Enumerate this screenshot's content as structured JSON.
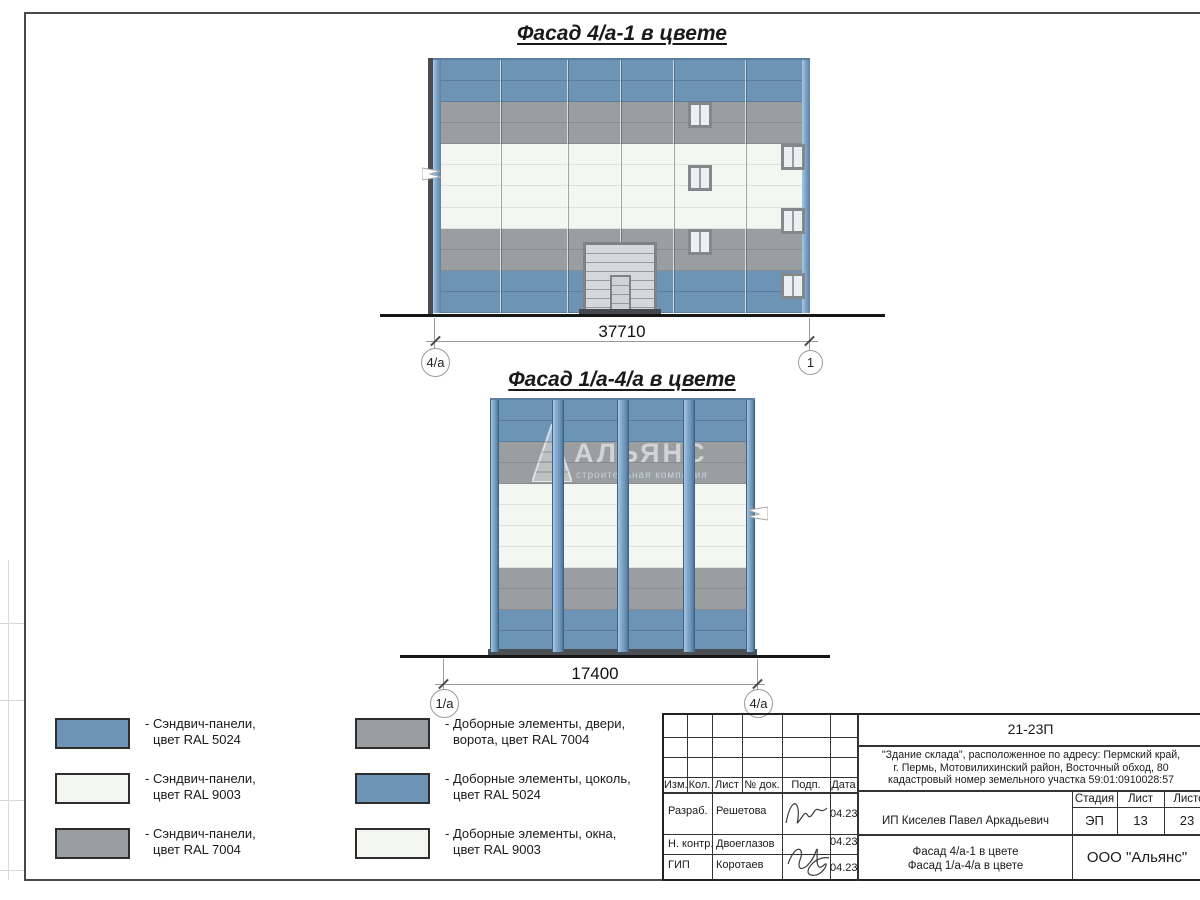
{
  "colors": {
    "panel_blue": "#6e94b5",
    "panel_white": "#f3f6f1",
    "panel_gray": "#9b9ea0",
    "ink": "#1a1a1a"
  },
  "facade1": {
    "title": "Фасад 4/а-1 в цвете",
    "dimension": "37710",
    "axis_left": "4/а",
    "axis_right": "1"
  },
  "facade2": {
    "title": "Фасад 1/а-4/а в цвете",
    "dimension": "17400",
    "axis_left": "1/а",
    "axis_right": "4/а",
    "watermark_name": "АЛЬЯНС",
    "watermark_tagline": "строительная компания"
  },
  "legend": {
    "items": [
      {
        "color": "#6e94b5",
        "line1": "- Сэндвич-панели,",
        "line2": "цвет RAL 5024"
      },
      {
        "color": "#f3f6f1",
        "line1": "- Сэндвич-панели,",
        "line2": "цвет RAL 9003"
      },
      {
        "color": "#9b9ea0",
        "line1": "- Сэндвич-панели,",
        "line2": "цвет RAL 7004"
      },
      {
        "color": "#9b9ea0",
        "line1": "- Доборные элементы, двери,",
        "line2": "ворота, цвет RAL 7004"
      },
      {
        "color": "#6e94b5",
        "line1": "- Доборные элементы, цоколь,",
        "line2": "цвет RAL 5024"
      },
      {
        "color": "#f3f6f1",
        "line1": "- Доборные элементы, окна,",
        "line2": "цвет RAL 9003"
      }
    ]
  },
  "titleblock": {
    "code": "21-23П",
    "address_line1": "\"Здание склада\", расположенное по адресу: Пермский край,",
    "address_line2": "г. Пермь, Мотовилихинский район, Восточный обход, 80",
    "address_line3": "кадастровый номер земельного участка 59:01:0910028:57",
    "client": "ИП Киселев Павел Аркадьевич",
    "sheet_title_line1": "Фасад 4/а-1 в цвете",
    "sheet_title_line2": "Фасад 1/а-4/а в цвете",
    "organization": "ООО \"Альянс\"",
    "columns": {
      "izm": "Изм.",
      "kol": "Кол.",
      "list": "Лист",
      "doc": "№ док.",
      "podp": "Подп.",
      "data": "Дата"
    },
    "stage_header": "Стадия",
    "sheet_header": "Лист",
    "sheets_header": "Листов",
    "stage": "ЭП",
    "sheet": "13",
    "sheets": "23",
    "rows": [
      {
        "role": "Разраб.",
        "name": "Решетова",
        "date": "04.23"
      },
      {
        "role": "Н. контр.",
        "name": "Двоеглазов",
        "date": "04.23"
      },
      {
        "role": "ГИП",
        "name": "Коротаев",
        "date": "04.23"
      }
    ]
  }
}
